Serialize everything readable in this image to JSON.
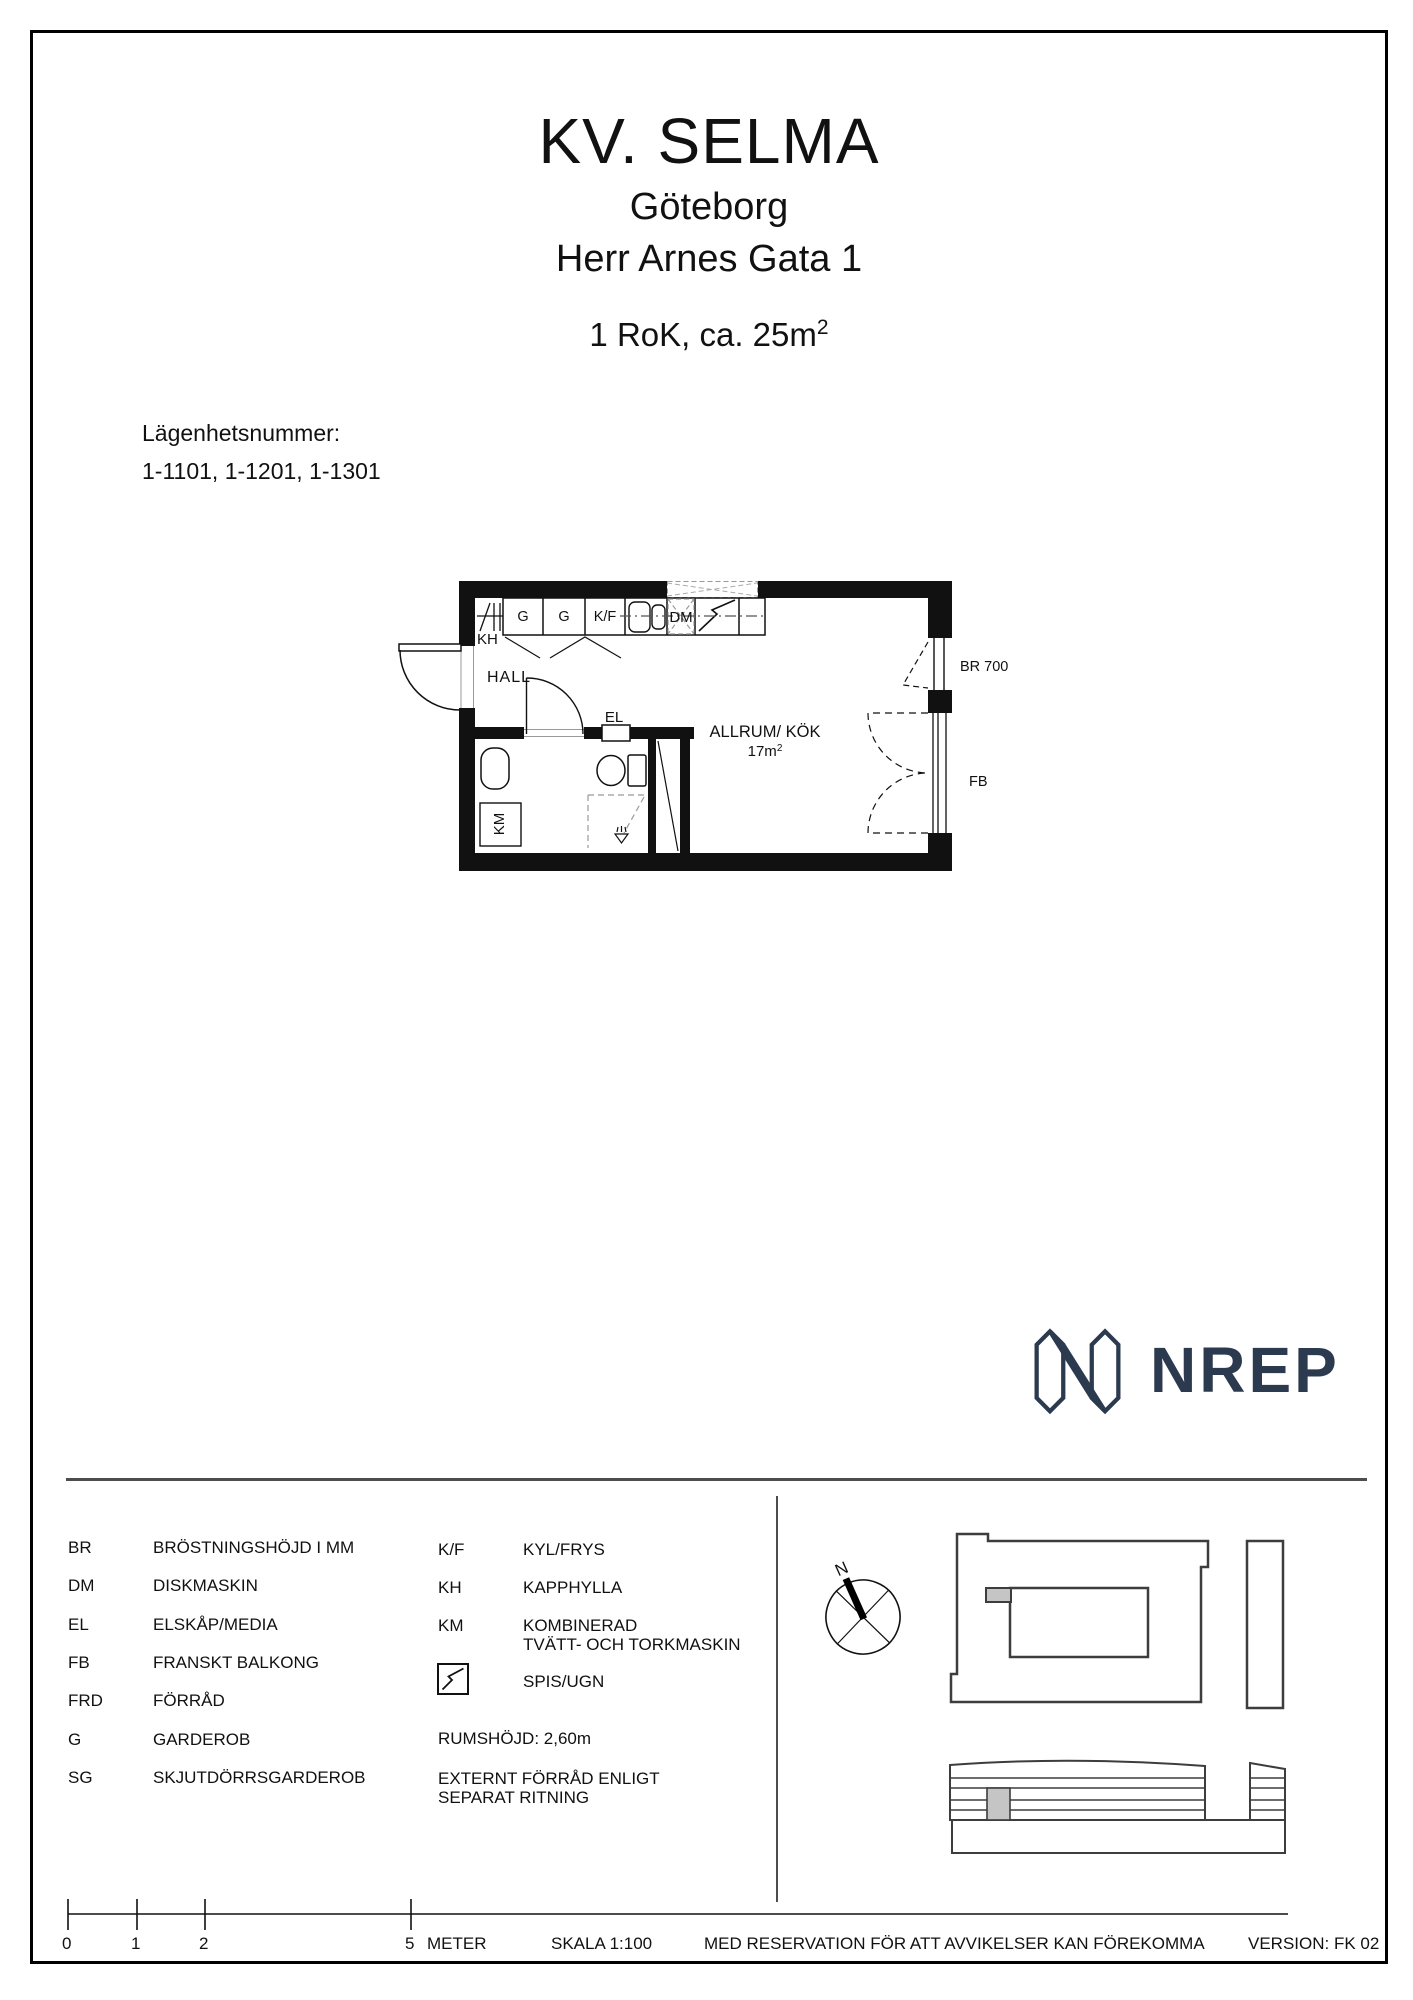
{
  "page": {
    "title_project": "KV. SELMA",
    "title_city": "Göteborg",
    "title_address": "Herr Arnes Gata 1",
    "rok_label": "1 RoK, ca. 25m",
    "rok_sup": "2"
  },
  "apartment": {
    "label": "Lägenhetsnummer:",
    "numbers": "1-1101, 1-1201, 1-1301"
  },
  "plan": {
    "kh": "KH",
    "g1": "G",
    "g2": "G",
    "kf": "K/F",
    "dm": "DM",
    "hall": "HALL",
    "el": "EL",
    "km": "KM",
    "room": "ALLRUM/ KÖK",
    "area": "17m",
    "area_sup": "2",
    "br": "BR 700",
    "fb": "FB"
  },
  "logo": {
    "text": "NREP",
    "color": "#2b3a4e"
  },
  "legend": {
    "left": [
      {
        "abbr": "BR",
        "desc": "BRÖSTNINGSHÖJD I MM"
      },
      {
        "abbr": "DM",
        "desc": "DISKMASKIN"
      },
      {
        "abbr": "EL",
        "desc": "ELSKÅP/MEDIA"
      },
      {
        "abbr": "FB",
        "desc": "FRANSKT BALKONG"
      },
      {
        "abbr": "FRD",
        "desc": "FÖRRÅD"
      },
      {
        "abbr": "G",
        "desc": "GARDEROB"
      },
      {
        "abbr": "SG",
        "desc": "SKJUTDÖRRSGARDEROB"
      }
    ],
    "right": [
      {
        "abbr": "K/F",
        "desc": "KYL/FRYS"
      },
      {
        "abbr": "KH",
        "desc": "KAPPHYLLA"
      },
      {
        "abbr": "KM",
        "desc": "KOMBINERAD",
        "desc2": "TVÄTT- OCH TORKMASKIN"
      }
    ],
    "stove_label": "SPIS/UGN",
    "room_height": "RUMSHÖJD: 2,60m",
    "external_line1": "EXTERNT FÖRRÅD ENLIGT",
    "external_line2": "SEPARAT RITNING"
  },
  "compass": {
    "north": "N"
  },
  "footer": {
    "tick0": "0",
    "tick1": "1",
    "tick2": "2",
    "tick5": "5",
    "meter": "METER",
    "scale": "SKALA 1:100",
    "disclaimer": "MED RESERVATION FÖR ATT AVVIKELSER KAN FÖREKOMMA",
    "version": "VERSION: FK 02"
  },
  "colors": {
    "accent_navy": "#2b3a4e",
    "highlight_gray": "#c5c5c5",
    "line_black": "#111111",
    "line_gray": "#3d3d3d"
  }
}
